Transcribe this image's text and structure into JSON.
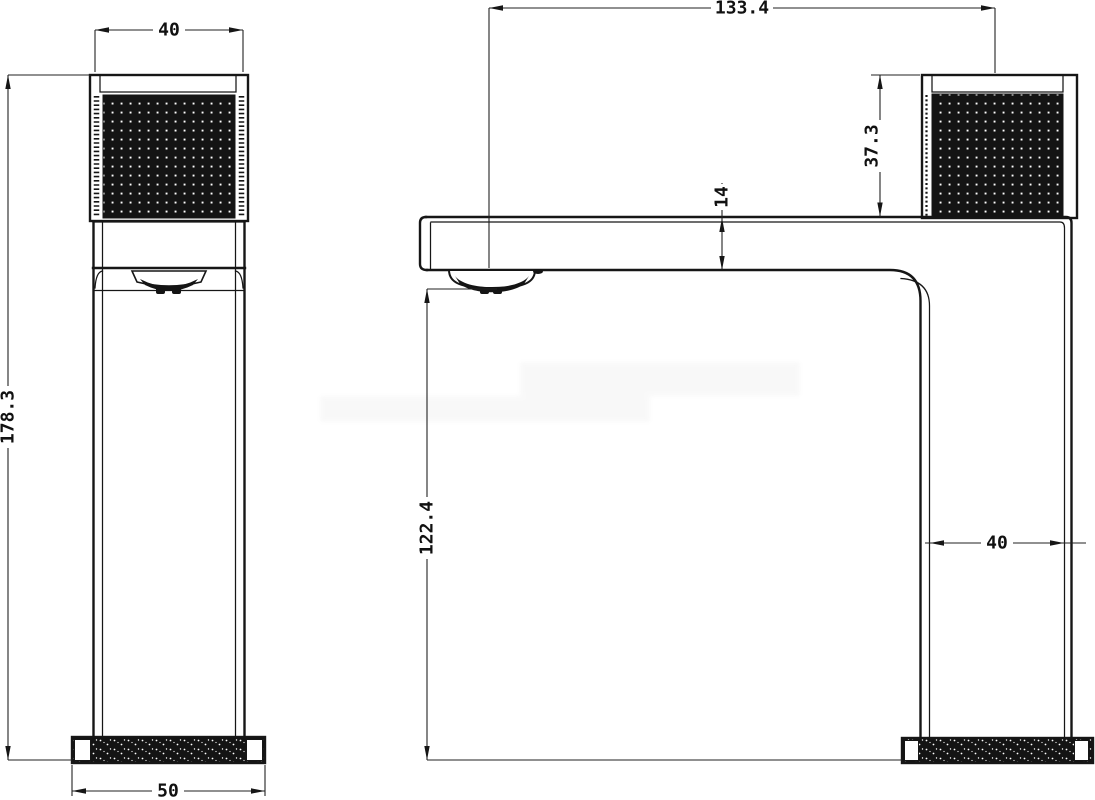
{
  "page": {
    "background": "#ffffff",
    "line_color": "#161616"
  },
  "views": {
    "front": {
      "dimensions": {
        "handle_width": "40",
        "total_height": "178.3",
        "base_width": "50"
      }
    },
    "side": {
      "dimensions": {
        "spout_reach": "133.4",
        "handle_height": "37.3",
        "spout_thickness": "14",
        "spout_to_base": "122.4",
        "body_depth": "40"
      }
    }
  }
}
